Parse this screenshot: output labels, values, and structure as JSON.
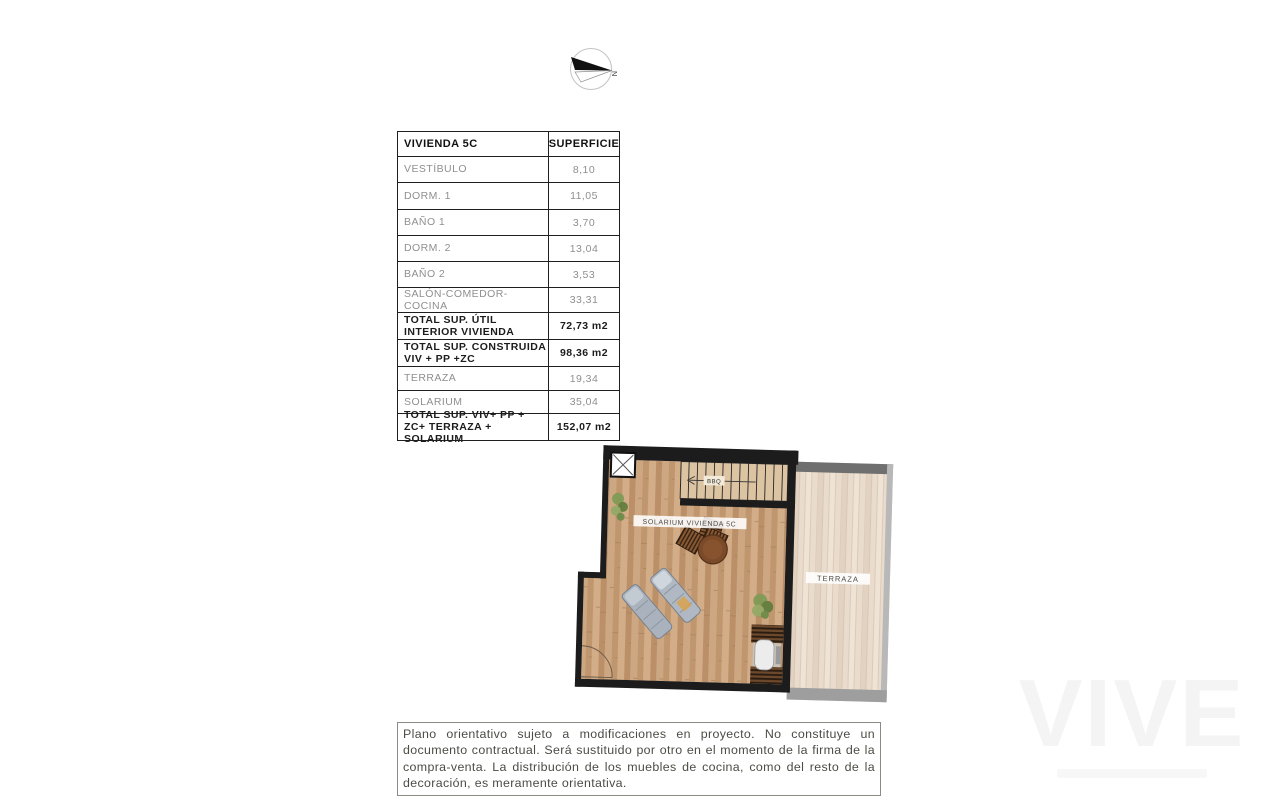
{
  "compass": {
    "label": "N"
  },
  "area_table": {
    "header": {
      "col1": "VIVIENDA 5C",
      "col2": "SUPERFICIE"
    },
    "rows": [
      {
        "label": "VESTÍBULO",
        "value": "8,10"
      },
      {
        "label": "DORM. 1",
        "value": "11,05"
      },
      {
        "label": "BAÑO 1",
        "value": "3,70"
      },
      {
        "label": "DORM. 2",
        "value": "13,04"
      },
      {
        "label": "BAÑO 2",
        "value": "3,53"
      },
      {
        "label": "SALÓN-COMEDOR-COCINA",
        "value": "33,31"
      },
      {
        "label": "TOTAL SUP. ÚTIL INTERIOR VIVIENDA",
        "value": "72,73 m2"
      },
      {
        "label": "TOTAL SUP. CONSTRUIDA VIV + PP +ZC",
        "value": "98,36 m2"
      },
      {
        "label": "TERRAZA",
        "value": "19,34"
      },
      {
        "label": "SOLARIUM",
        "value": "35,04"
      },
      {
        "label": "TOTAL SUP. VIV+ PP + ZC+ TERRAZA + SOLARIUM",
        "value": "152,07 m2"
      }
    ]
  },
  "floor_plan": {
    "solarium_label": "SOLARIUM VIVIENDA 5C",
    "terrace_label": "TERRAZA",
    "stairs_label": "BBQ",
    "colors": {
      "wall": "#1c1c1c",
      "terrace_wall_dark": "#6f6f6f",
      "terrace_wall_light": "#b8b8b8",
      "terrace_wall_bottom": "#9e9e9e"
    }
  },
  "disclaimer": {
    "text": "Plano orientativo sujeto a modificaciones en proyecto. No constituye un documento contractual. Será sustituido por otro en el momento de la firma de la compra-venta. La distribución de los muebles de cocina, como del resto de la decoración, es meramente orientativa."
  },
  "watermark": {
    "text": "VIVE"
  }
}
